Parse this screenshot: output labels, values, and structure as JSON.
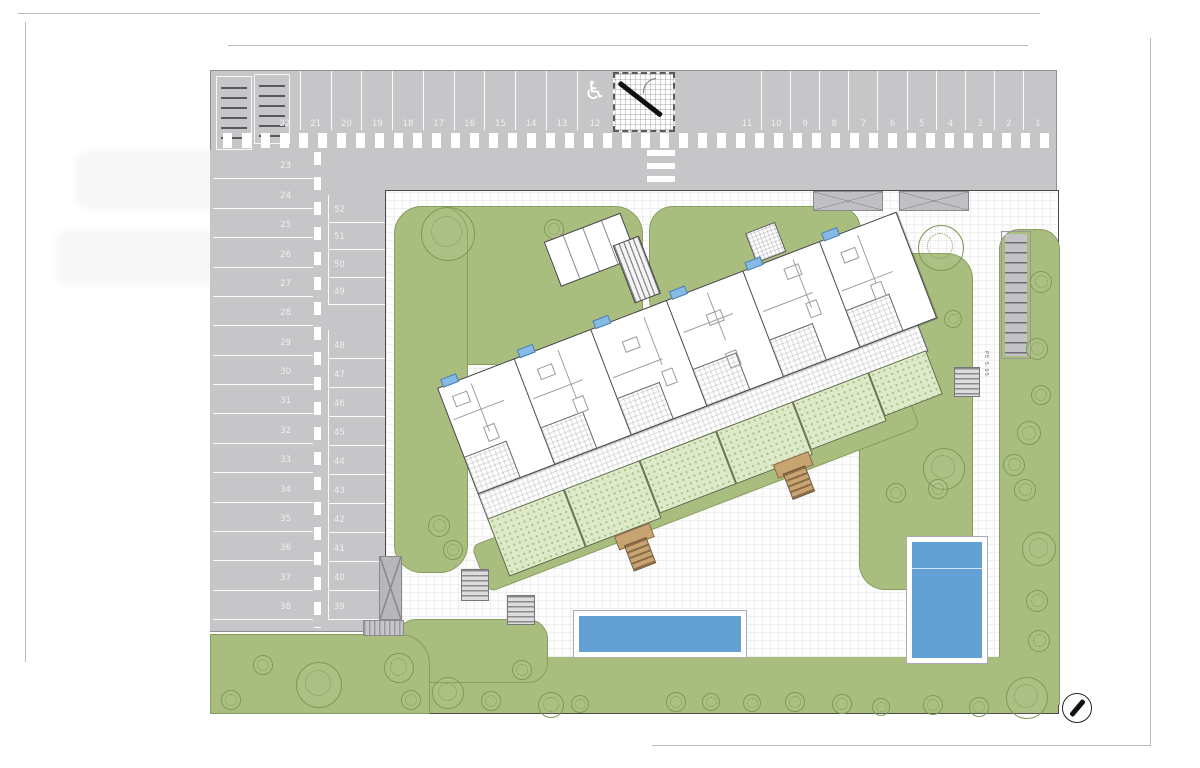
{
  "parking": {
    "top_row_left": [
      "22",
      "21",
      "20",
      "19",
      "18",
      "17",
      "16",
      "15",
      "14",
      "13",
      "12"
    ],
    "top_row_right": [
      "11",
      "10",
      "9",
      "8",
      "7",
      "6",
      "5",
      "4",
      "3",
      "2",
      "1"
    ],
    "west_column": [
      "23",
      "24",
      "25",
      "26",
      "27",
      "28",
      "29",
      "30",
      "31",
      "32",
      "33",
      "34",
      "35",
      "36",
      "37",
      "38"
    ],
    "inner_column_upper": [
      "52",
      "51",
      "50",
      "49"
    ],
    "inner_column_lower": [
      "48",
      "47",
      "46",
      "45",
      "44",
      "43",
      "42",
      "41",
      "40",
      "39"
    ],
    "accessible_stall_number": "12",
    "accessible_icon": "♿"
  },
  "site": {
    "path_label": "PE 5.05",
    "apartment_units_count": 6,
    "pools_count": 2
  },
  "colors": {
    "road_gray": "#c6c6c9",
    "landscape_green": "#a9bd7e",
    "private_garden_green": "#dde9c8",
    "pool_blue": "#63a0d4",
    "window_marker_blue": "#86b9e4",
    "stair_tan": "#c9a473",
    "stair_brown": "#8a6b45"
  },
  "landscape": {
    "trees": [
      {
        "x": 447,
        "y": 233,
        "r": 26,
        "kind": "tree"
      },
      {
        "x": 553,
        "y": 228,
        "r": 9,
        "kind": "bush"
      },
      {
        "x": 940,
        "y": 247,
        "r": 22,
        "kind": "tree"
      },
      {
        "x": 952,
        "y": 318,
        "r": 8,
        "kind": "bush"
      },
      {
        "x": 1040,
        "y": 281,
        "r": 10,
        "kind": "bush"
      },
      {
        "x": 1036,
        "y": 348,
        "r": 10,
        "kind": "bush"
      },
      {
        "x": 1040,
        "y": 394,
        "r": 9,
        "kind": "bush"
      },
      {
        "x": 1028,
        "y": 432,
        "r": 11,
        "kind": "bush"
      },
      {
        "x": 943,
        "y": 468,
        "r": 20,
        "kind": "tree"
      },
      {
        "x": 1013,
        "y": 464,
        "r": 10,
        "kind": "bush"
      },
      {
        "x": 895,
        "y": 492,
        "r": 9,
        "kind": "bush"
      },
      {
        "x": 937,
        "y": 488,
        "r": 9,
        "kind": "bush"
      },
      {
        "x": 438,
        "y": 525,
        "r": 10,
        "kind": "bush"
      },
      {
        "x": 452,
        "y": 549,
        "r": 9,
        "kind": "bush"
      },
      {
        "x": 1024,
        "y": 489,
        "r": 10,
        "kind": "bush"
      },
      {
        "x": 1038,
        "y": 548,
        "r": 16,
        "kind": "tree"
      },
      {
        "x": 1036,
        "y": 600,
        "r": 10,
        "kind": "bush"
      },
      {
        "x": 1038,
        "y": 640,
        "r": 10,
        "kind": "bush"
      },
      {
        "x": 1026,
        "y": 697,
        "r": 20,
        "kind": "tree"
      },
      {
        "x": 318,
        "y": 684,
        "r": 22,
        "kind": "tree"
      },
      {
        "x": 398,
        "y": 667,
        "r": 14,
        "kind": "tree"
      },
      {
        "x": 230,
        "y": 699,
        "r": 9,
        "kind": "bush"
      },
      {
        "x": 262,
        "y": 664,
        "r": 9,
        "kind": "bush"
      },
      {
        "x": 410,
        "y": 699,
        "r": 9,
        "kind": "bush"
      },
      {
        "x": 447,
        "y": 692,
        "r": 15,
        "kind": "tree"
      },
      {
        "x": 490,
        "y": 700,
        "r": 9,
        "kind": "bush"
      },
      {
        "x": 521,
        "y": 669,
        "r": 9,
        "kind": "bush"
      },
      {
        "x": 550,
        "y": 704,
        "r": 12,
        "kind": "tree"
      },
      {
        "x": 579,
        "y": 703,
        "r": 8,
        "kind": "bush"
      },
      {
        "x": 675,
        "y": 701,
        "r": 9,
        "kind": "bush"
      },
      {
        "x": 710,
        "y": 701,
        "r": 8,
        "kind": "bush"
      },
      {
        "x": 751,
        "y": 702,
        "r": 8,
        "kind": "bush"
      },
      {
        "x": 794,
        "y": 701,
        "r": 9,
        "kind": "bush"
      },
      {
        "x": 841,
        "y": 703,
        "r": 9,
        "kind": "bush"
      },
      {
        "x": 880,
        "y": 706,
        "r": 8,
        "kind": "bush"
      },
      {
        "x": 932,
        "y": 704,
        "r": 9,
        "kind": "bush"
      },
      {
        "x": 978,
        "y": 706,
        "r": 9,
        "kind": "bush"
      }
    ]
  }
}
